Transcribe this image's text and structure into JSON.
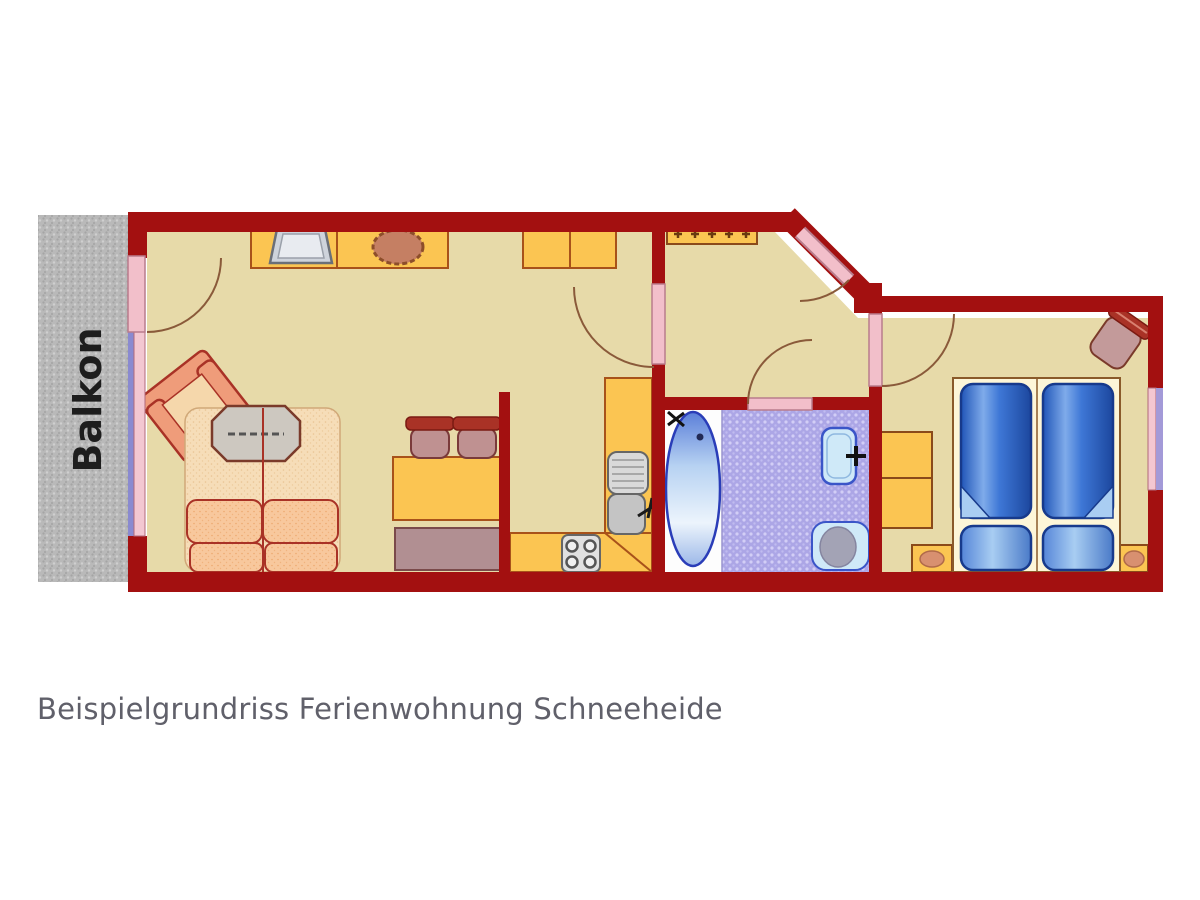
{
  "caption": "Beispielgrundriss Ferienwohnung Schneeheide",
  "balcony": {
    "label": "Balkon"
  },
  "colors": {
    "wall": "#a31010",
    "floor": "#e7daa9",
    "furniture_yellow": "#fbc552",
    "furniture_outline": "#a8521a",
    "upholstery_peach": "#f8c89d",
    "upholstery_outline": "#a93226",
    "bathroom_tile": "#aca6e6",
    "fixture_blue": "#cfe9f8",
    "fixture_outline": "#3a55c8",
    "bed_blue": "#3a70d0",
    "door_leaf_pink": "#f2bfca",
    "window_lavender": "#9a93d6",
    "window_pink": "#f3c7d1",
    "balcony_gray": "#b9b9b9",
    "caption_text": "#60606a"
  },
  "icons": [
    "tv-icon",
    "plant-icon",
    "sideboard-icon",
    "cabinet-icon",
    "armchair-icon",
    "sofa-bed-icon",
    "coffee-table-icon",
    "dining-table-icon",
    "dining-chair-icon",
    "bench-icon",
    "kitchen-counter-icon",
    "sink-icon",
    "stove-icon",
    "coat-rack-icon",
    "bathtub-icon",
    "washbasin-icon",
    "toilet-icon",
    "wardrobe-icon",
    "twin-bed-icon",
    "pillow-icon",
    "nightstand-icon",
    "desk-chair-icon",
    "door-swing-arc-icon",
    "window-icon"
  ]
}
